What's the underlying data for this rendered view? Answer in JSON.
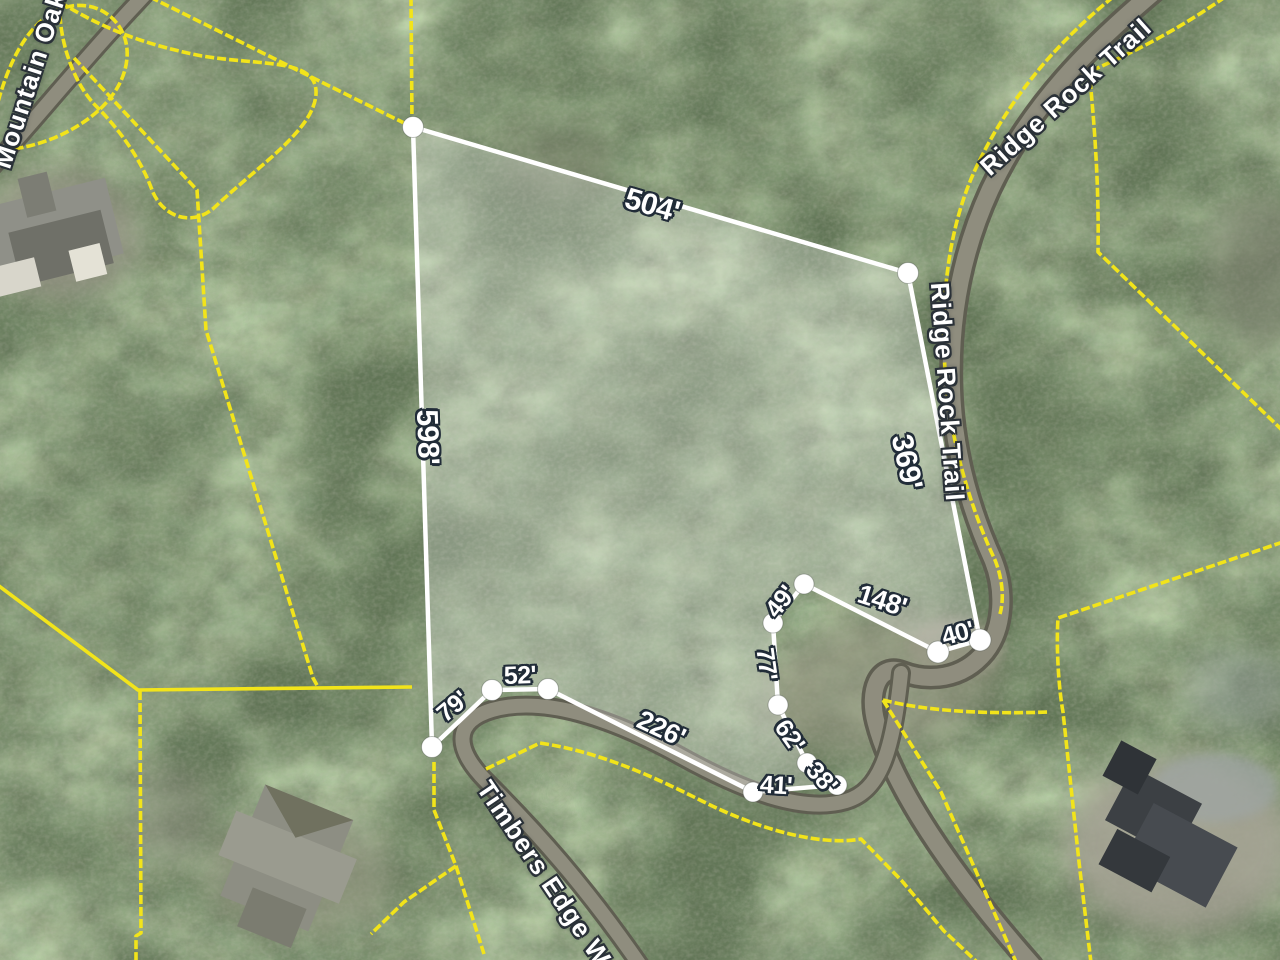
{
  "streets": {
    "ridge_rock_upper": "Ridge Rock Trail",
    "ridge_rock_lower": "Ridge Rock Trail",
    "mountain_oak": "Mountain Oak",
    "timbers_edge": "Timbers Edge Way"
  },
  "parcel": {
    "edge_labels": {
      "e504": "504'",
      "e598": "598'",
      "e369": "369'",
      "e148": "148'",
      "e40": "40'",
      "e49": "49'",
      "e77": "77'",
      "e62": "62'",
      "e38": "38'",
      "e41": "41'",
      "e226": "226'",
      "e52": "52'",
      "e79": "79'"
    }
  },
  "colors": {
    "boundary-yellow": "#f2e41a",
    "parcel-line": "#ffffff",
    "parcel-fill": "rgba(255,255,255,0.26)",
    "road-gray": "#8f8d7e",
    "label-halo": "#212c38"
  }
}
